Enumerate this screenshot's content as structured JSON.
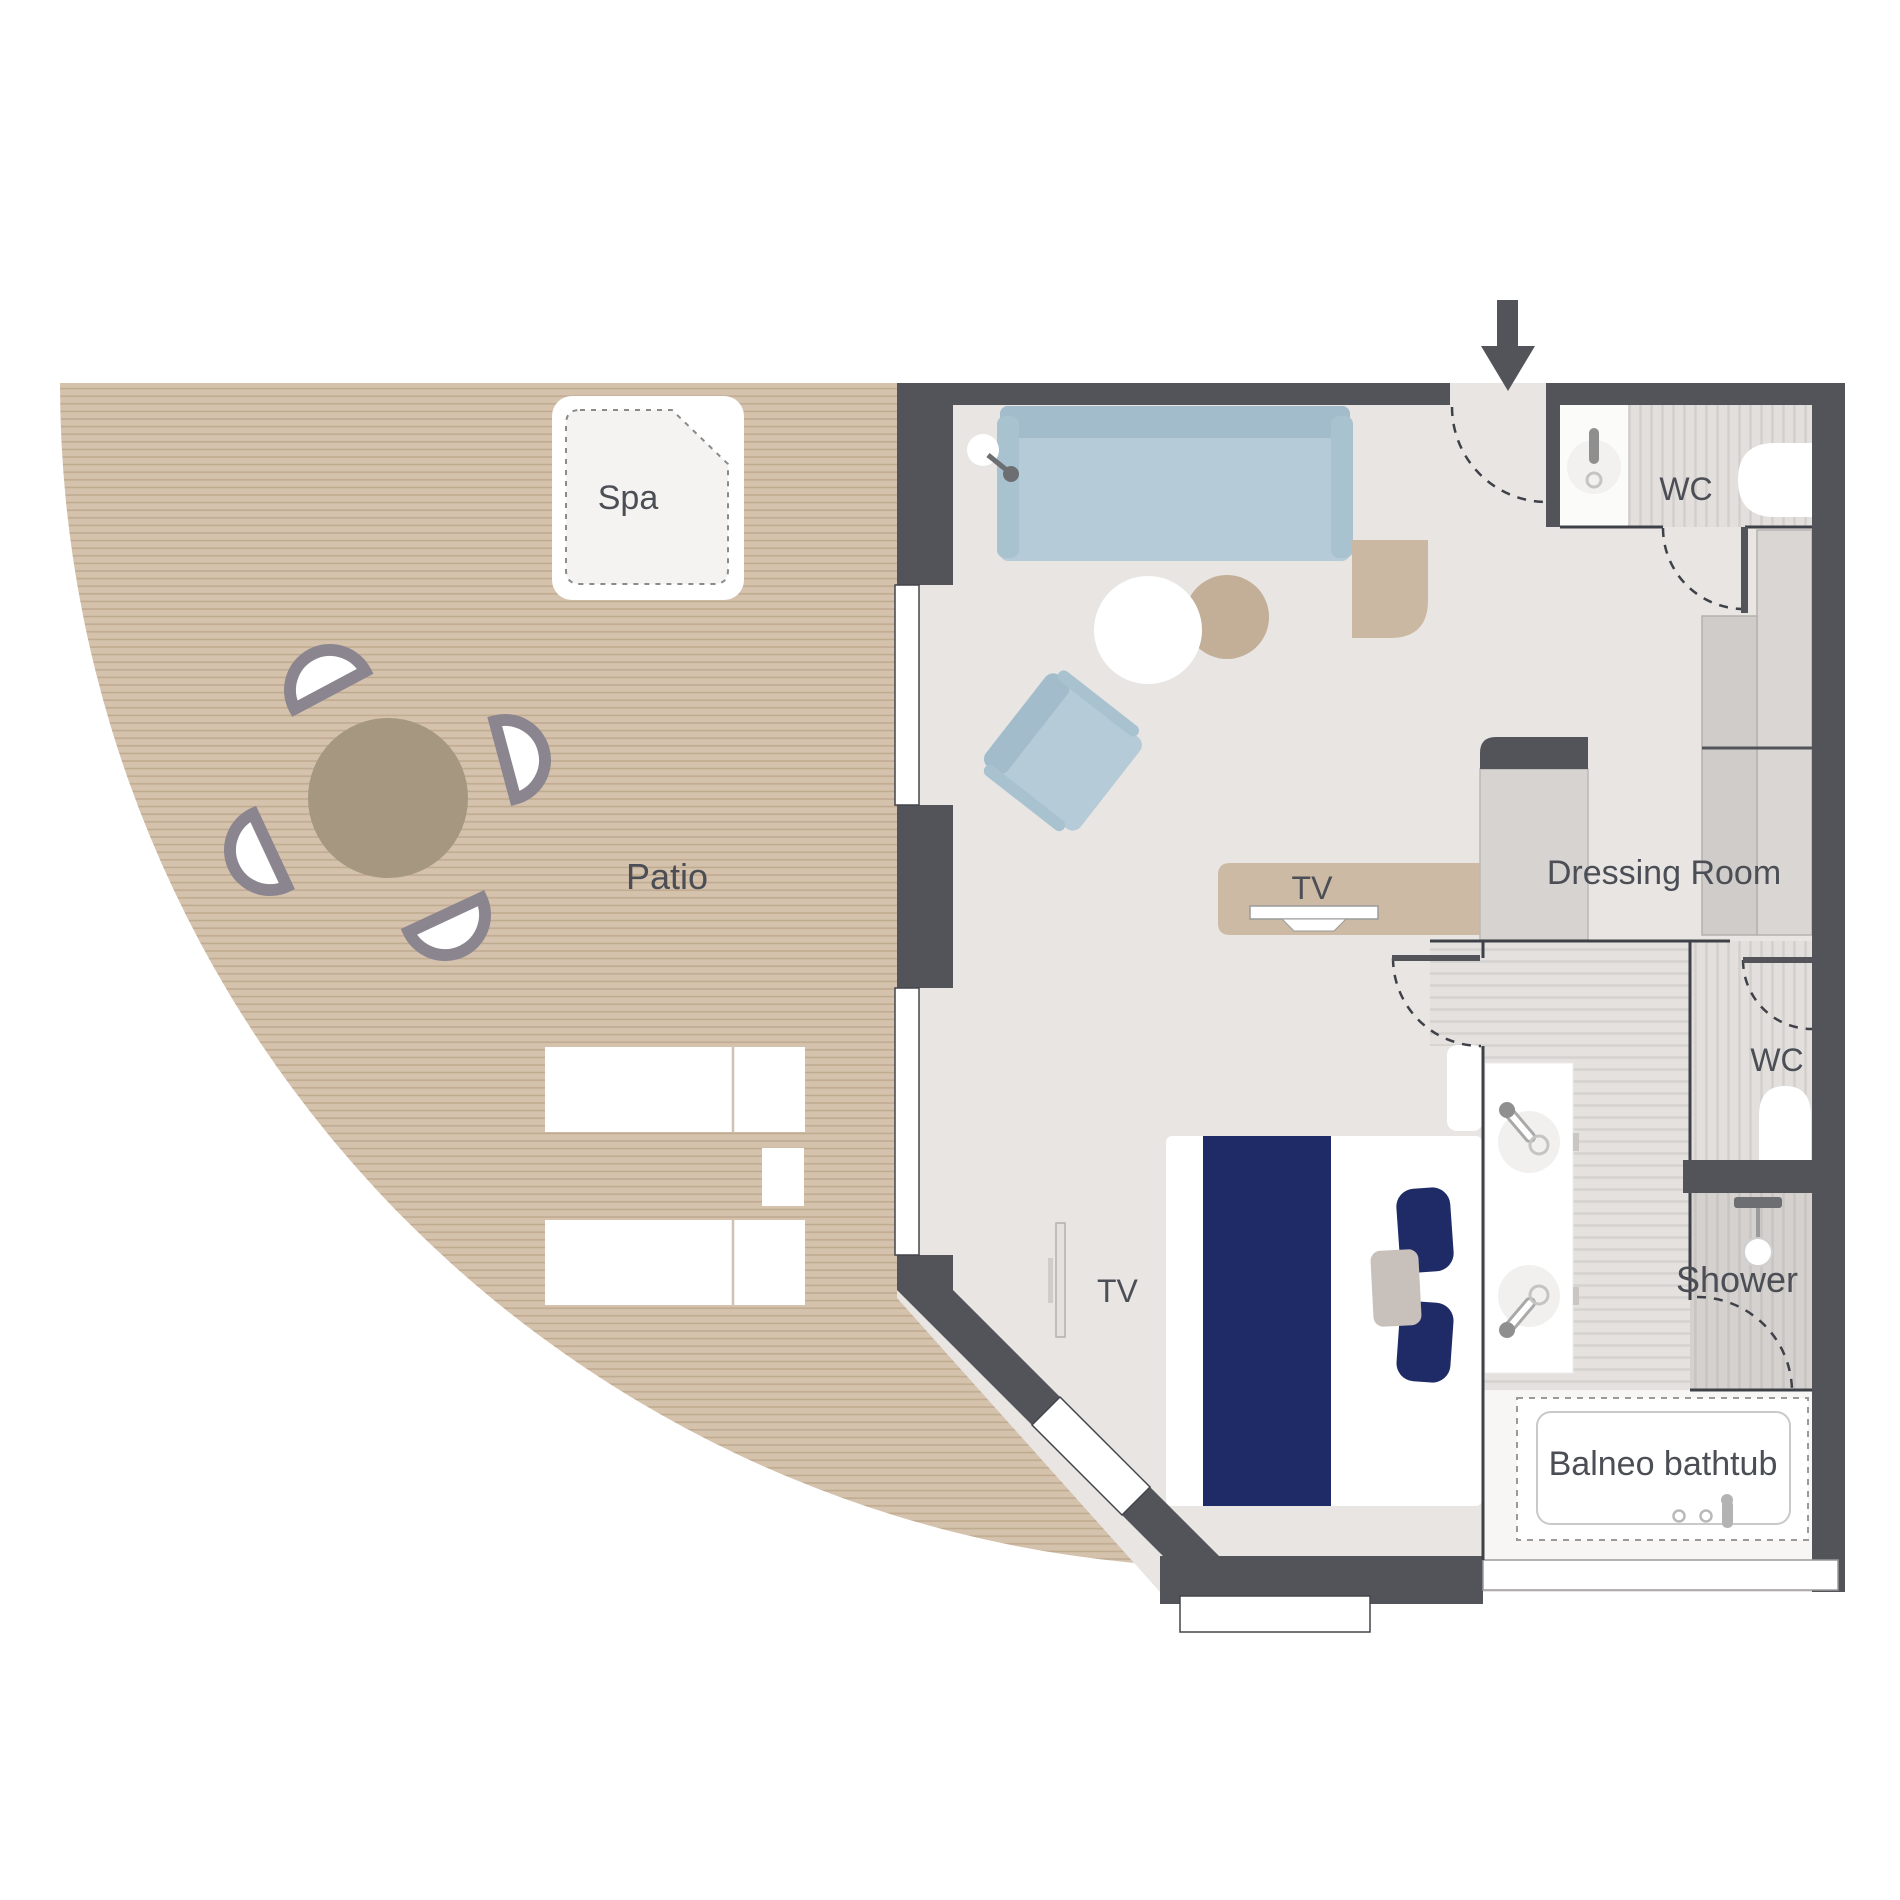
{
  "title": "Suite floor plan",
  "labels": {
    "spa": "Spa",
    "patio": "Patio",
    "living_tv": "TV",
    "dressing_room": "Dressing Room",
    "wc_top": "WC",
    "bedroom_tv": "TV",
    "wc_lower": "WC",
    "shower": "Shower",
    "bathtub": "Balneo bathtub"
  },
  "colors": {
    "wall": "#53545a",
    "floor": "#e8e5e2",
    "deck": "#d4c2ac",
    "deck_stripe": "#bfa98f",
    "sofa": "#b6cbd8",
    "sofa_back": "#a2bccb",
    "wood_furniture": "#ccbaa5",
    "bed_navy": "#1f2b66",
    "text": "#4b4e55",
    "stripe_floor": "#d5d2cf"
  }
}
